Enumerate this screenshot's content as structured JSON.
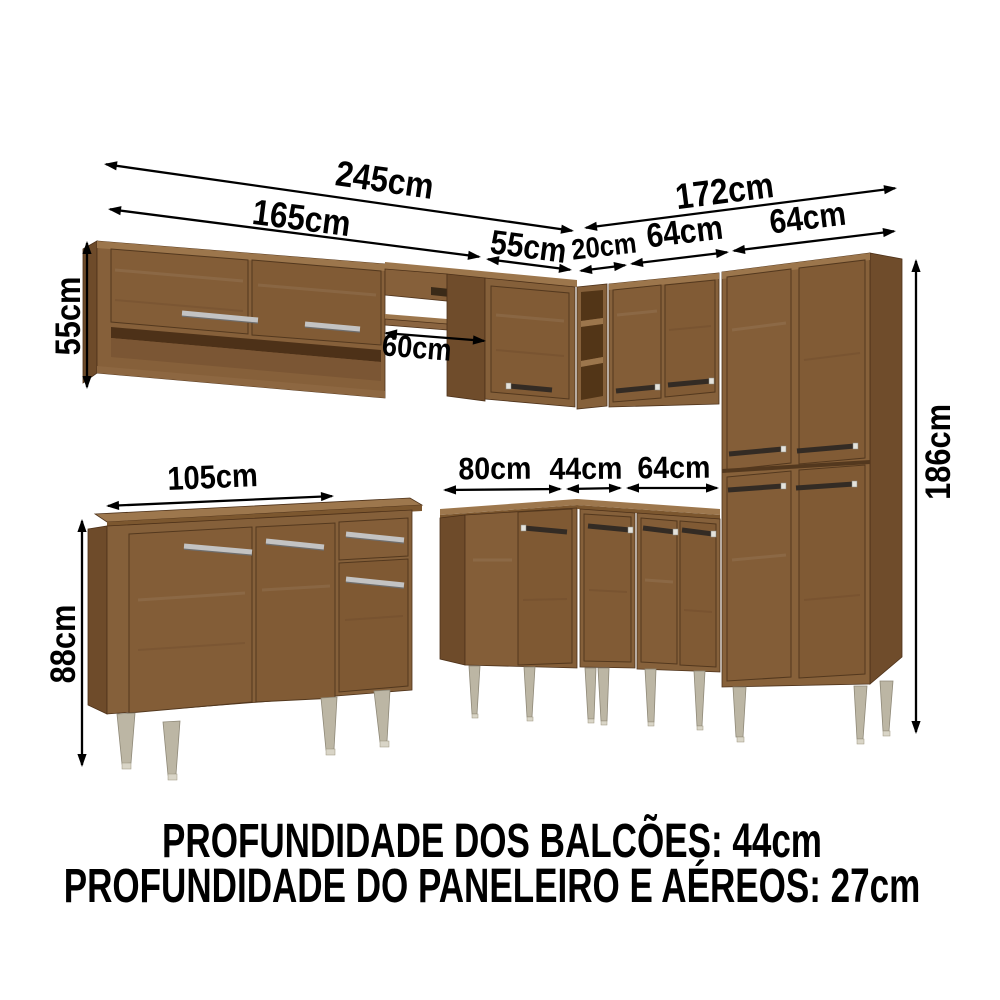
{
  "diagram": {
    "kind": "kitchen-cabinet-set-dimension-diagram",
    "dims": {
      "left_run_total": "245cm",
      "left_upper_cabinet": "165cm",
      "corner_upper_cabinet": "55cm",
      "right_run_total": "172cm",
      "upper_shelf_unit": "20cm",
      "right_upper_cabinet": "64cm",
      "tall_cabinet_width": "64cm",
      "upper_cabinet_height": "55cm",
      "niche_width": "60cm",
      "left_base_cabinet": "105cm",
      "base_cabinet_height": "88cm",
      "corner_base_cabinet": "80cm",
      "mid_base_cabinet": "44cm",
      "right_base_cabinet": "64cm",
      "tall_cabinet_height": "186cm"
    },
    "footer": {
      "line1": "PROFUNDIDADE DOS BALCÕES: 44cm",
      "line2": "PROFUNDIDADE DO PANELEIRO E AÉREOS: 27cm"
    },
    "colors": {
      "background": "#ffffff",
      "text": "#000000",
      "wood_front": "#85603a",
      "wood_side": "#6e4b2a",
      "wood_top": "#9c764c",
      "wood_interior": "#523517",
      "leg": "#bcb6a4",
      "handle_dark": "#332b24",
      "handle_chrome": "#c3c3c3"
    }
  }
}
